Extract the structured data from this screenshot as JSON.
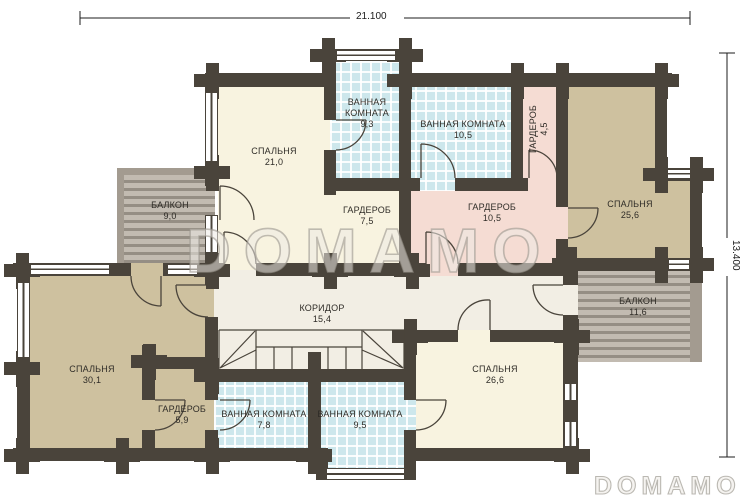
{
  "dimensions": {
    "width": "21.100",
    "height": "13.400"
  },
  "watermarks": {
    "center": "DOMAMO",
    "corner": "DOMAMO"
  },
  "rooms": {
    "bedroom21": {
      "name": "СПАЛЬНЯ",
      "area": "21,0"
    },
    "bath93": {
      "name": "ВАННАЯ КОМНАТА",
      "area": "9,3"
    },
    "bath105": {
      "name": "ВАННАЯ КОМНАТА",
      "area": "10,5"
    },
    "ward45": {
      "name": "ГАРДЕРОБ",
      "area": "4,5"
    },
    "bedroom256": {
      "name": "СПАЛЬНЯ",
      "area": "25,6"
    },
    "ward75": {
      "name": "ГАРДЕРОБ",
      "area": "7,5"
    },
    "ward105": {
      "name": "ГАРДЕРОБ",
      "area": "10,5"
    },
    "balcony9": {
      "name": "БАЛКОН",
      "area": "9,0"
    },
    "corridor": {
      "name": "КОРИДОР",
      "area": "15,4"
    },
    "bedroom301": {
      "name": "СПАЛЬНЯ",
      "area": "30,1"
    },
    "ward59": {
      "name": "ГАРДЕРОБ",
      "area": "5,9"
    },
    "bath78": {
      "name": "ВАННАЯ КОМНАТА",
      "area": "7,8"
    },
    "bath95": {
      "name": "ВАННАЯ КОМНАТА",
      "area": "9,5"
    },
    "bedroom266": {
      "name": "СПАЛЬНЯ",
      "area": "26,6"
    },
    "balcony116": {
      "name": "БАЛКОН",
      "area": "11,6"
    }
  }
}
